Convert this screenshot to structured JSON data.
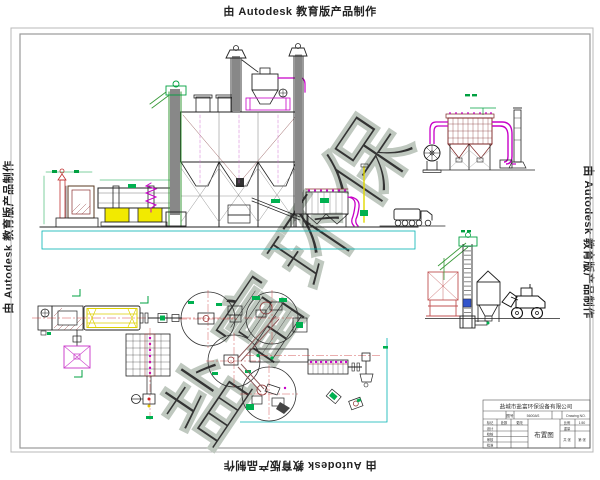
{
  "watermarks": {
    "autodesk": "由 Autodesk 教育版产品制作",
    "diagonal_brand": "盐富环保"
  },
  "title_block": {
    "company": "盐城市盐富环保设备有限公司",
    "drawing_title": "布置图",
    "drawing_no_label": "图号",
    "drawing_no": "5600AS",
    "drawing_no_en": "Drawing NO.",
    "scale_label": "比例",
    "scale_value": "1:50",
    "weight_label": "重量",
    "sheet_total": "共 张",
    "sheet_index": "第 张",
    "qty_label": "处数",
    "change_label": "更改",
    "sign_rows": [
      "标记",
      "设计",
      "校核",
      "审核",
      "批准"
    ]
  },
  "palette": {
    "paper": "#ffffff",
    "line": "#1a1a1a",
    "maroon": "#8c2f2f",
    "magenta": "#c800c8",
    "green": "#00a040",
    "yellow": "#f2ea00",
    "cyan": "#00b3b3",
    "red_centerline": "#cc3333",
    "watermark_outline": "#bfc8bf",
    "border_gray": "#9a9a9a",
    "wm_text": "#222222"
  }
}
